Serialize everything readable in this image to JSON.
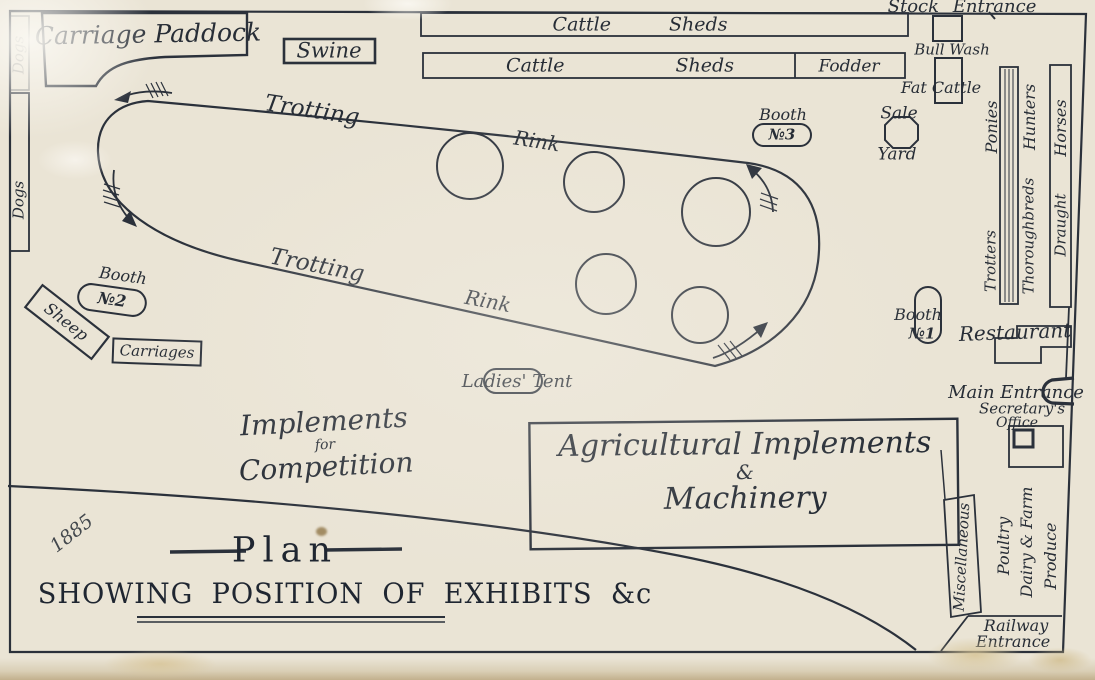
{
  "title": {
    "main": "Plan",
    "subtitle": "SHOWING POSITION OF EXHIBITS &c",
    "year_note": "1885"
  },
  "colors": {
    "paper": "#eae4d5",
    "ink": "#2b313b"
  },
  "rink": {
    "name_word1": "Trotting",
    "name_word2": "Rink",
    "ring_count": 5
  },
  "labels": {
    "carriage_paddock": "Carriage Paddock",
    "swine": "Swine",
    "cattle_sheds_top": "Cattle Sheds",
    "cattle_sheds_bottom": "Cattle Sheds",
    "fodder": "Fodder",
    "stock_entrance": "Stock Entrance",
    "bull_wash": "Bull Wash",
    "fat_cattle": "Fat Cattle",
    "sale": "Sale",
    "yard": "Yard",
    "ponies": "Ponies",
    "hunters": "Hunters",
    "horses": "Horses",
    "trotters": "Trotters",
    "thoroughbreds": "Thoroughbreds",
    "draught": "Draught",
    "sheep": "Sheep",
    "carriages": "Carriages",
    "dogs": "Dogs",
    "ladies_tent": "Ladies' Tent",
    "restaurant": "Restaurant",
    "main_entrance": "Main Entrance",
    "secretarys_office_line1": "Secretary's",
    "secretarys_office_line2": "Office",
    "miscellaneous": "Miscellaneous",
    "poultry_line1": "Poultry",
    "poultry_line2": "Dairy & Farm",
    "poultry_line3": "Produce",
    "railway_line1": "Railway",
    "railway_line2": "Entrance"
  },
  "booths": {
    "b1": {
      "label": "Booth",
      "no": "№1"
    },
    "b2": {
      "label": "Booth",
      "no": "№2"
    },
    "b3": {
      "label": "Booth",
      "no": "№3"
    }
  },
  "implements_block": {
    "line1": "Implements",
    "line2": "for",
    "line3": "Competition"
  },
  "agricultural_block": {
    "line1": "Agricultural Implements",
    "line2": "&",
    "line3": "Machinery"
  }
}
